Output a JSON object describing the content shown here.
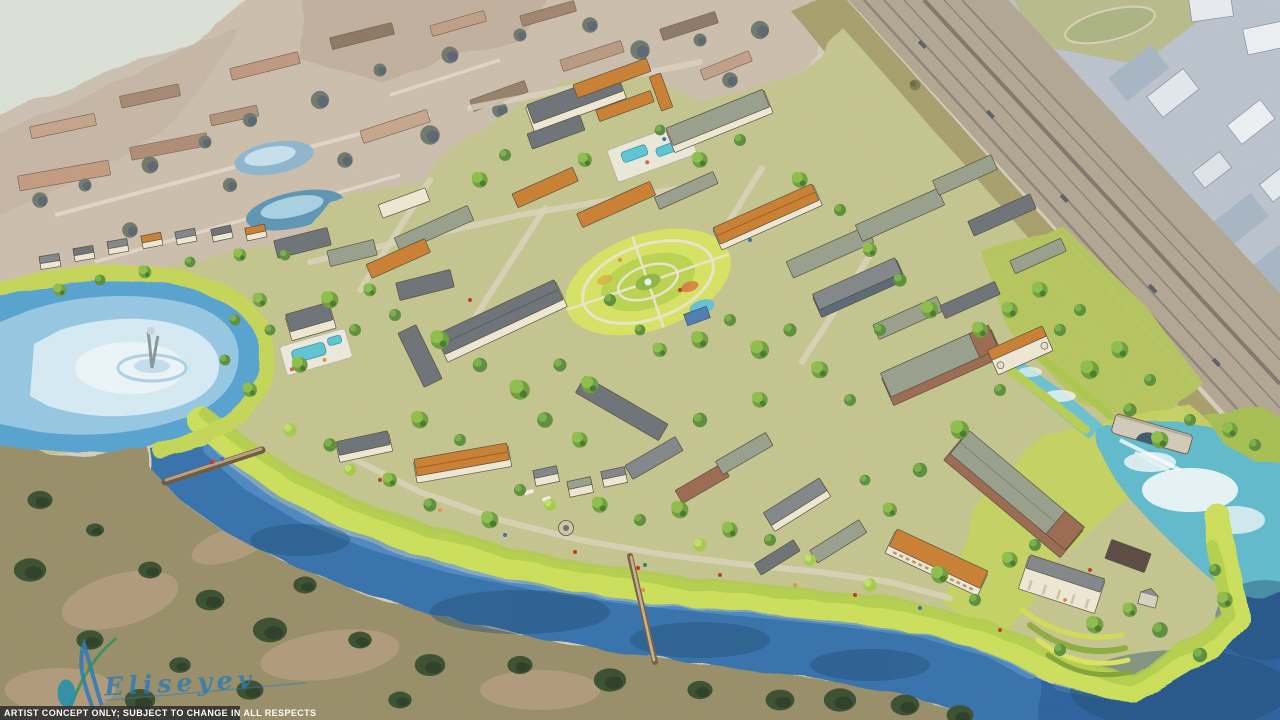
{
  "scene": {
    "title": "Aerial watercolor artist rendering of a proposed riverside mixed-use village",
    "features": [
      "lake with fountain",
      "winding river",
      "pedestrian bridges",
      "stone arch bridge and weir pool",
      "central oval garden park",
      "swimming pool courtyards",
      "apartment blocks with orange and gray roofs",
      "riverfront townhomes",
      "lakeside clubhouse and pool",
      "terraced garden amphitheater",
      "rail and highway corridor",
      "hazy existing neighborhood",
      "commercial area beyond corridor",
      "scrub preserve"
    ]
  },
  "overlay": {
    "caption": "ARTIST CONCEPT ONLY; SUBJECT TO CHANGE IN ALL RESPECTS",
    "signature": "Eliseyev"
  },
  "palette": {
    "river_blue": "#3873ae",
    "lake_light": "#cfe9f4",
    "lagoon_aqua": "#6cc3d4",
    "bank_green": "#cde05c",
    "tree_green": "#6fa23f",
    "roof_orange": "#cb8133",
    "roof_gray": "#83888b",
    "wall_cream": "#f0e9d6",
    "scrub_olive": "#99906a",
    "haze_tan": "#cdbfae",
    "corridor_gray": "#b3a894",
    "caption_bg": "#2b2b2b",
    "caption_text": "#ffffff",
    "signature_blue": "#2b7ab8"
  }
}
